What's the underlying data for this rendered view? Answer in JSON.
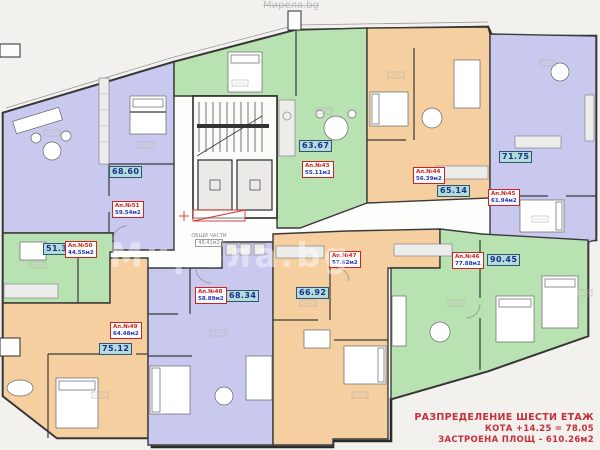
{
  "plan": {
    "watermark": "Мирела.bg",
    "common_area": {
      "title": "ОБЩИ ЧАСТИ",
      "area": "48.41м2"
    },
    "title_block": {
      "line1": "РАЗПРЕДЕЛЕНИЕ ШЕСТИ ЕТАЖ",
      "line2": "КОТА +14.25 = 78.05",
      "line3": "ЗАСТРОЕНА ПЛОЩ - 610.26м2"
    },
    "apartments": [
      {
        "key": "ap43",
        "number": "Ап.№43",
        "net_area": "55.11м2",
        "total_area": "63.67",
        "color_group": "green"
      },
      {
        "key": "ap44",
        "number": "Ап.№44",
        "net_area": "56.39м2",
        "total_area": "65.14",
        "color_group": "orange"
      },
      {
        "key": "ap45",
        "number": "Ап.№45",
        "net_area": "61.94м2",
        "total_area": "71.75",
        "color_group": "purple"
      },
      {
        "key": "ap46",
        "number": "Ап.№46",
        "net_area": "77.88м2",
        "total_area": "90.45",
        "color_group": "green"
      },
      {
        "key": "ap47",
        "number": "Ап.№47",
        "net_area": "57.62м2",
        "total_area": "66.92",
        "color_group": "orange"
      },
      {
        "key": "ap48",
        "number": "Ап.№48",
        "net_area": "58.89м2",
        "total_area": "68.34",
        "color_group": "purple"
      },
      {
        "key": "ap49",
        "number": "Ап.№49",
        "net_area": "64.48м2",
        "total_area": "75.12",
        "color_group": "orange"
      },
      {
        "key": "ap50",
        "number": "Ап.№50",
        "net_area": "44.55м2",
        "total_area": "51.33",
        "color_group": "green"
      },
      {
        "key": "ap51",
        "number": "Ап.№51",
        "net_area": "59.54м2",
        "total_area": "68.60",
        "color_group": "purple"
      }
    ],
    "colors": {
      "unit_purple": "#c9c9ef",
      "unit_green": "#b9e2b3",
      "unit_orange": "#f6cfa0",
      "badge_bg": "#b2dcdc",
      "badge_text": "#1b2f8a",
      "label_red": "#cc2222",
      "label_blue": "#2233bb",
      "title_red": "#c5303c",
      "wall": "#2b2b2b"
    }
  }
}
